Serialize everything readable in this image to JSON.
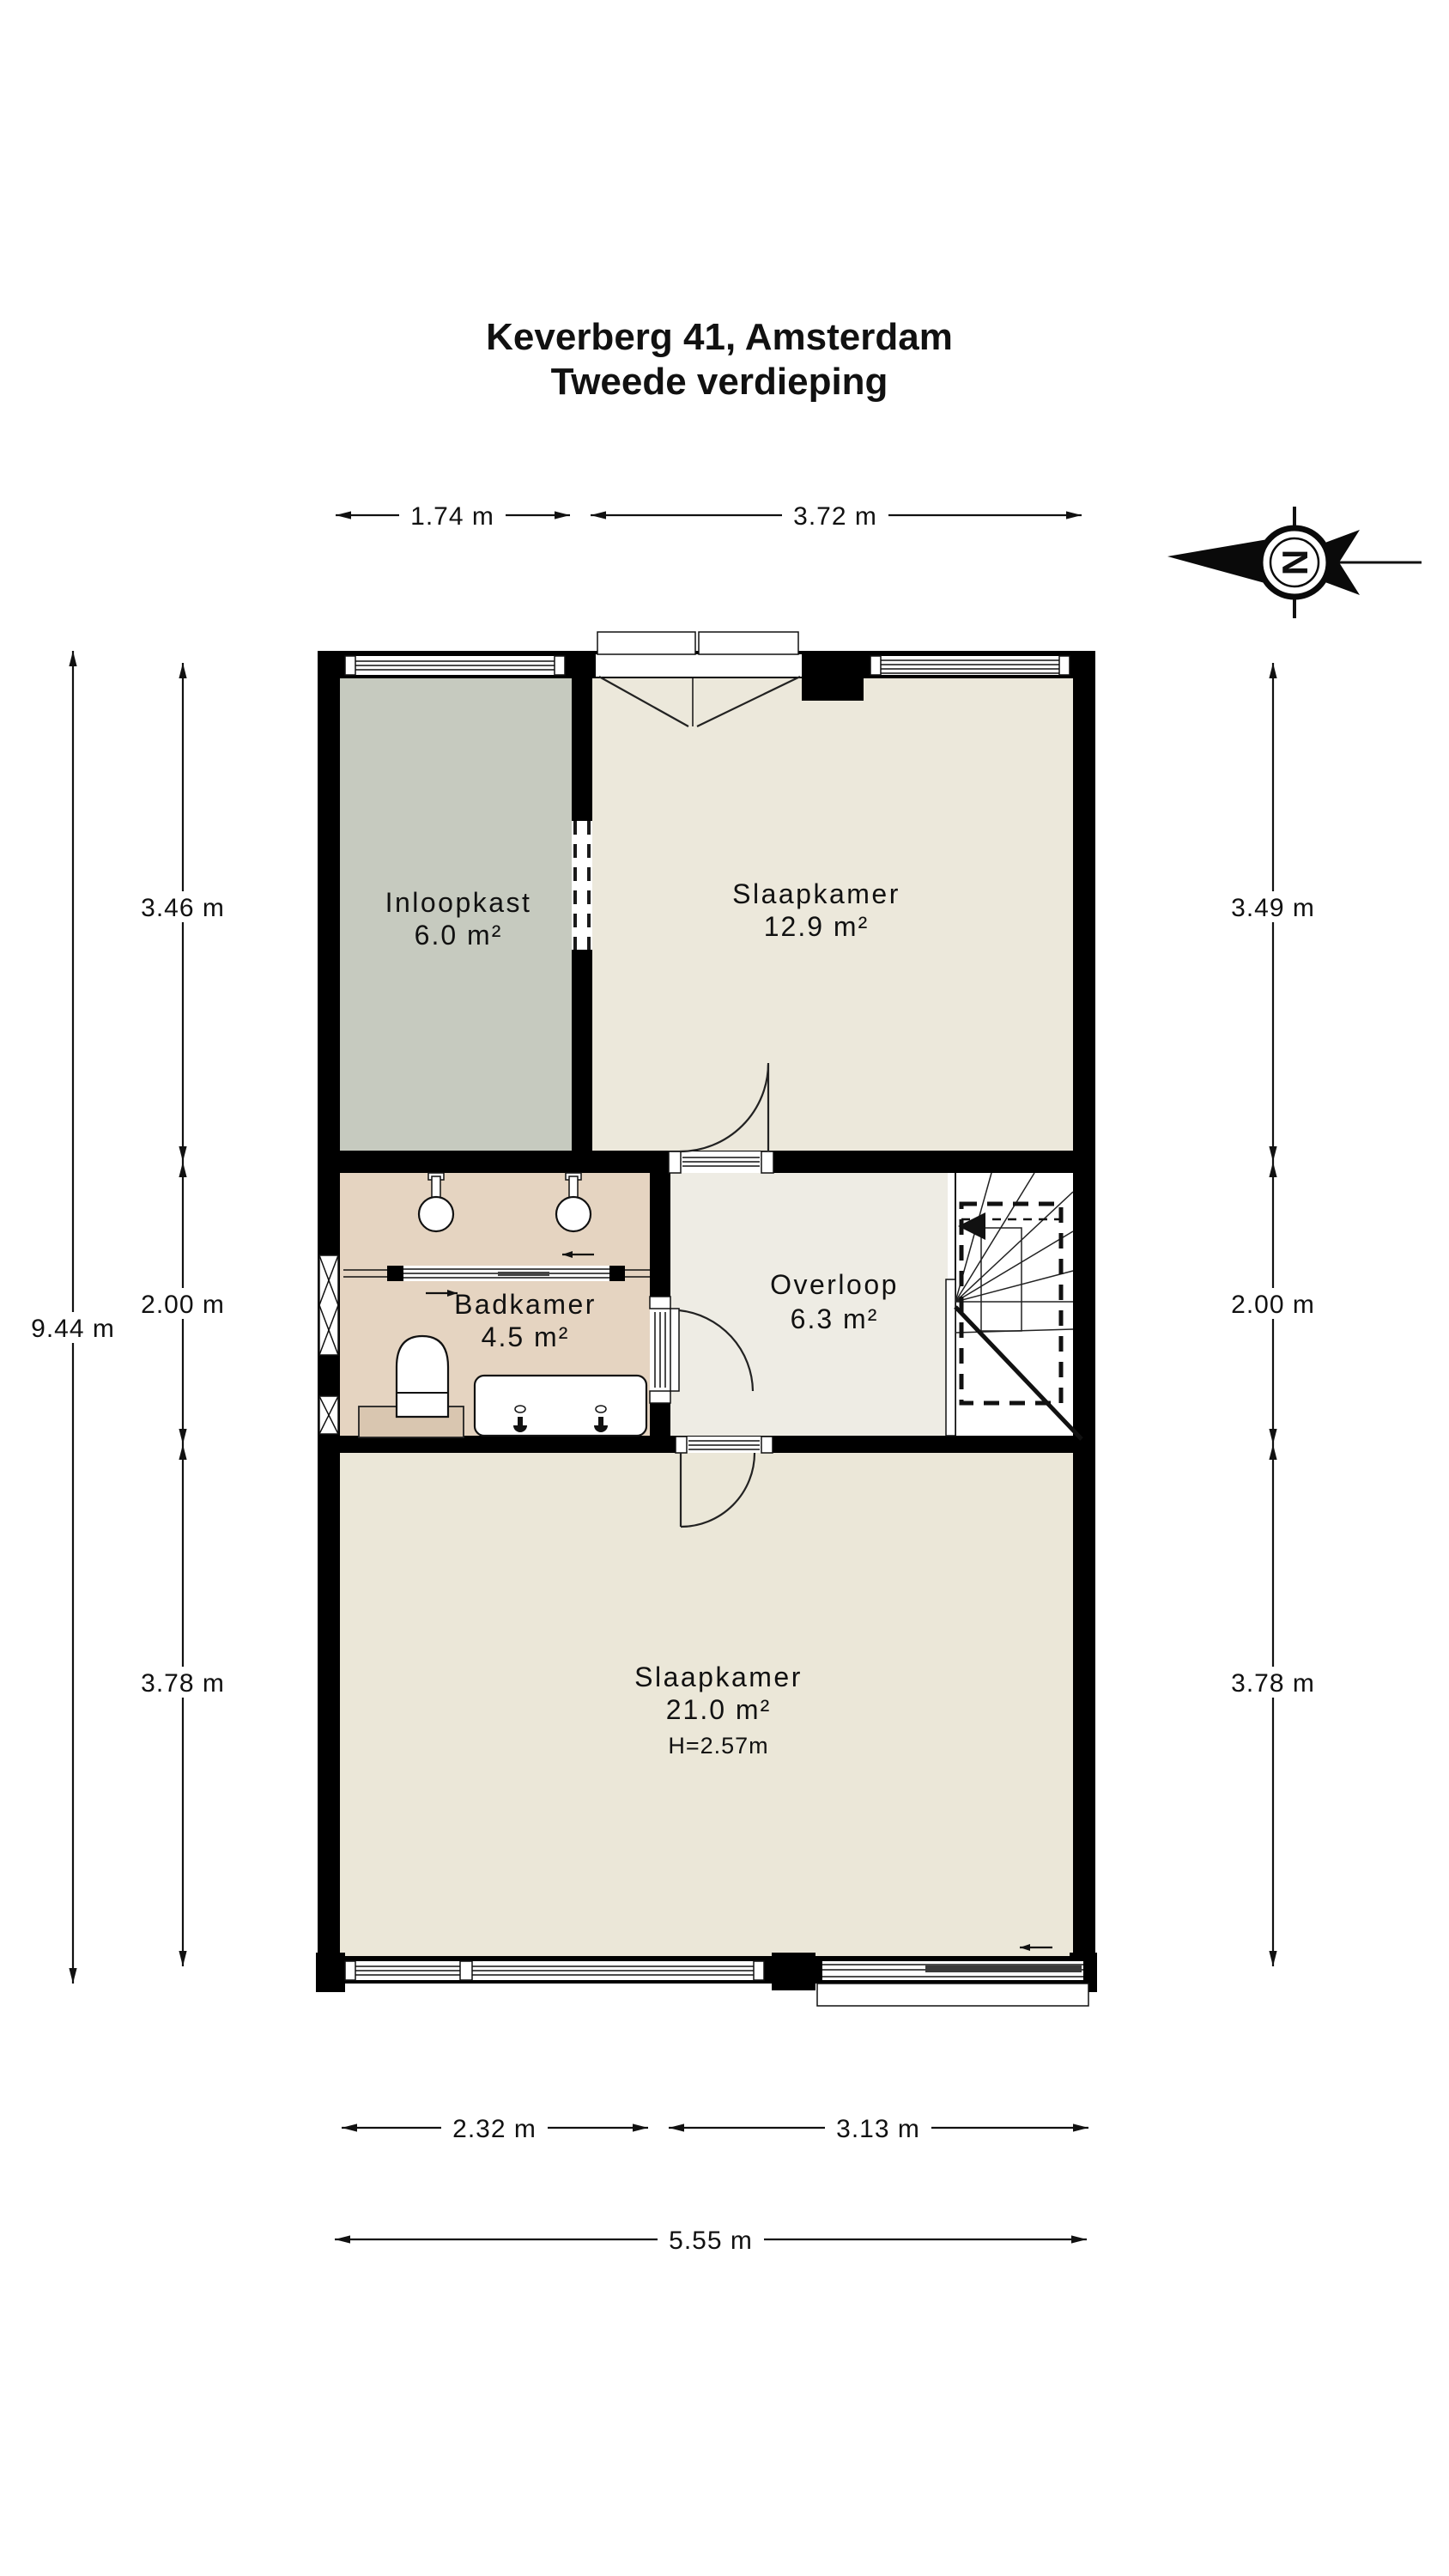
{
  "title": {
    "line1": "Keverberg 41, Amsterdam",
    "line2": "Tweede verdieping"
  },
  "compass": {
    "letter": "N"
  },
  "rooms": {
    "inloopkast": {
      "name": "Inloopkast",
      "area": "6.0 m²"
    },
    "slaapkamer_top": {
      "name": "Slaapkamer",
      "area": "12.9 m²"
    },
    "badkamer": {
      "name": "Badkamer",
      "area": "4.5 m²"
    },
    "overloop": {
      "name": "Overloop",
      "area": "6.3 m²"
    },
    "slaapkamer_bottom": {
      "name": "Slaapkamer",
      "area": "21.0 m²",
      "ceiling_height": "H=2.57m"
    }
  },
  "dimensions": {
    "top": [
      "1.74 m",
      "3.72 m"
    ],
    "left_segments": [
      "3.46 m",
      "2.00 m",
      "3.78 m"
    ],
    "left_total": "9.44 m",
    "right_segments": [
      "3.49 m",
      "2.00 m",
      "3.78 m"
    ],
    "bottom_segments": [
      "2.32 m",
      "3.13 m"
    ],
    "bottom_total": "5.55 m"
  },
  "colors": {
    "wall": "#000000",
    "inloopkast_floor": "#c6cabf",
    "bedroom_floor": "#ece8db",
    "bedroom_bottom_floor": "#ebe7d8",
    "badkamer_floor": "#e5d4c1",
    "overloop_floor": "#eeece4"
  }
}
